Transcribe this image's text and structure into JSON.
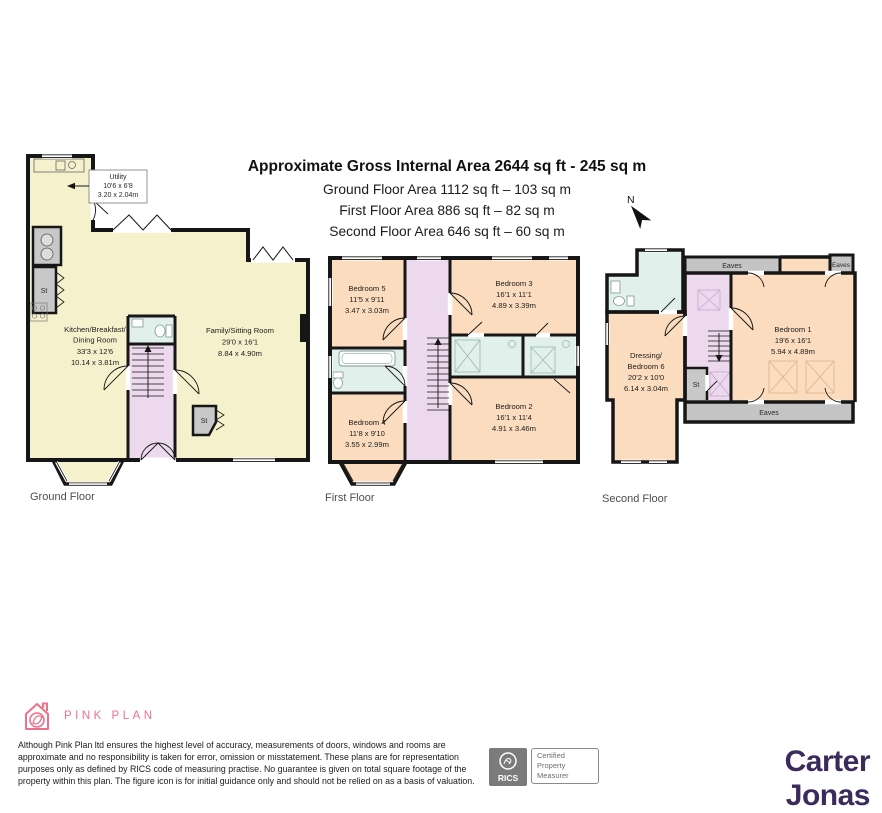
{
  "header": {
    "title": "Approximate Gross Internal Area 2644 sq ft - 245 sq m",
    "ground_line": "Ground Floor Area 1112 sq ft – 103 sq m",
    "first_line": "First Floor Area 886 sq ft – 82 sq m",
    "second_line": "Second Floor Area 646 sq ft – 60 sq m",
    "north": "N"
  },
  "floors": {
    "ground": {
      "caption": "Ground Floor",
      "utility": {
        "name": "Utility",
        "ft": "10'6 x 6'8",
        "m": "3.20 x 2.04m"
      },
      "kitchen": {
        "name": "Kitchen/Breakfast/",
        "name2": "Dining Room",
        "ft": "33'3 x 12'6",
        "m": "10.14 x 3.81m"
      },
      "family": {
        "name": "Family/Sitting Room",
        "ft": "29'0 x 16'1",
        "m": "8.84 x 4.90m"
      }
    },
    "first": {
      "caption": "First Floor",
      "bedroom5": {
        "name": "Bedroom 5",
        "ft": "11'5 x 9'11",
        "m": "3.47 x 3.03m"
      },
      "bedroom3": {
        "name": "Bedroom 3",
        "ft": "16'1 x 11'1",
        "m": "4.89 x 3.39m"
      },
      "bedroom4": {
        "name": "Bedroom 4",
        "ft": "11'8 x 9'10",
        "m": "3.55 x 2.99m"
      },
      "bedroom2": {
        "name": "Bedroom 2",
        "ft": "16'1 x 11'4",
        "m": "4.91 x 3.46m"
      }
    },
    "second": {
      "caption": "Second Floor",
      "bedroom1": {
        "name": "Bedroom 1",
        "ft": "19'6 x 16'1",
        "m": "5.94 x 4.89m"
      },
      "dressing": {
        "name": "Dressing/",
        "name2": "Bedroom 6",
        "ft": "20'2 x 10'0",
        "m": "6.14 x 3.04m"
      }
    }
  },
  "labels": {
    "st": "St",
    "eaves": "Eaves"
  },
  "footer": {
    "brand": "PINK PLAN",
    "disclaimer": "Although Pink Plan ltd ensures the highest level of accuracy, measurements of doors, windows and rooms are approximate and no responsibility is taken for error, omission or misstatement. These plans are for representation purposes only as defined by RICS code of measuring practise. No guarantee is given on total square footage of the property within this plan. The figure icon is for initial guidance only and should not be relied on as a basis of valuation.",
    "rics_name": "RICS",
    "rics_cert1": "Certified",
    "rics_cert2": "Property",
    "rics_cert3": "Measurer",
    "agent": "Carter Jonas"
  },
  "colors": {
    "wall": "#161616",
    "ground_room": "#f6f1cd",
    "bedroom": "#fbdcbe",
    "hall": "#ecd9ee",
    "bathroom": "#e2f0ec",
    "storage_gray": "#c8c8c8",
    "brand_pink": "#ef7189",
    "brand_purple": "#3b2b5c"
  }
}
